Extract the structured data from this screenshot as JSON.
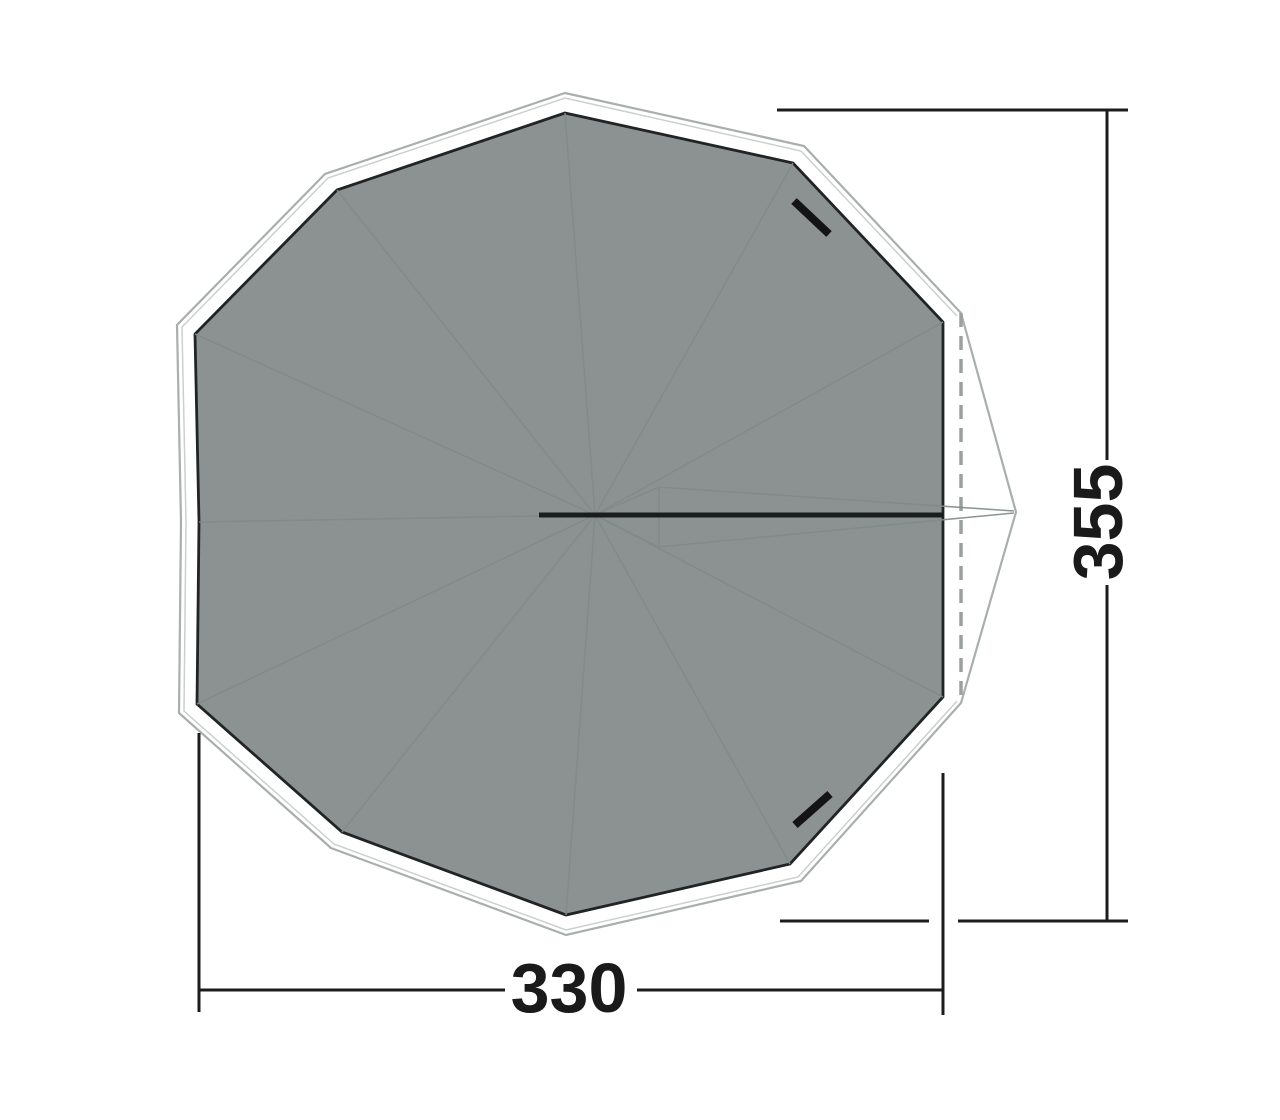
{
  "diagram": {
    "kind": "tent-floorplan-top-view",
    "dimensions": {
      "width_label": "330",
      "depth_label": "355"
    },
    "colors": {
      "background": "#FFFFFF",
      "floor_fill": "#8C9292",
      "floor_stroke": "#202424",
      "outer_outline": "#A9AEAE",
      "faint_outline": "#CBD0CF",
      "seam_spoke": "#828B8A",
      "center_pole_line": "#191D1D",
      "door_marker": "#141414",
      "door_fold_dash": "#9AA0A0",
      "dimension_line": "#1C1C1C"
    }
  }
}
